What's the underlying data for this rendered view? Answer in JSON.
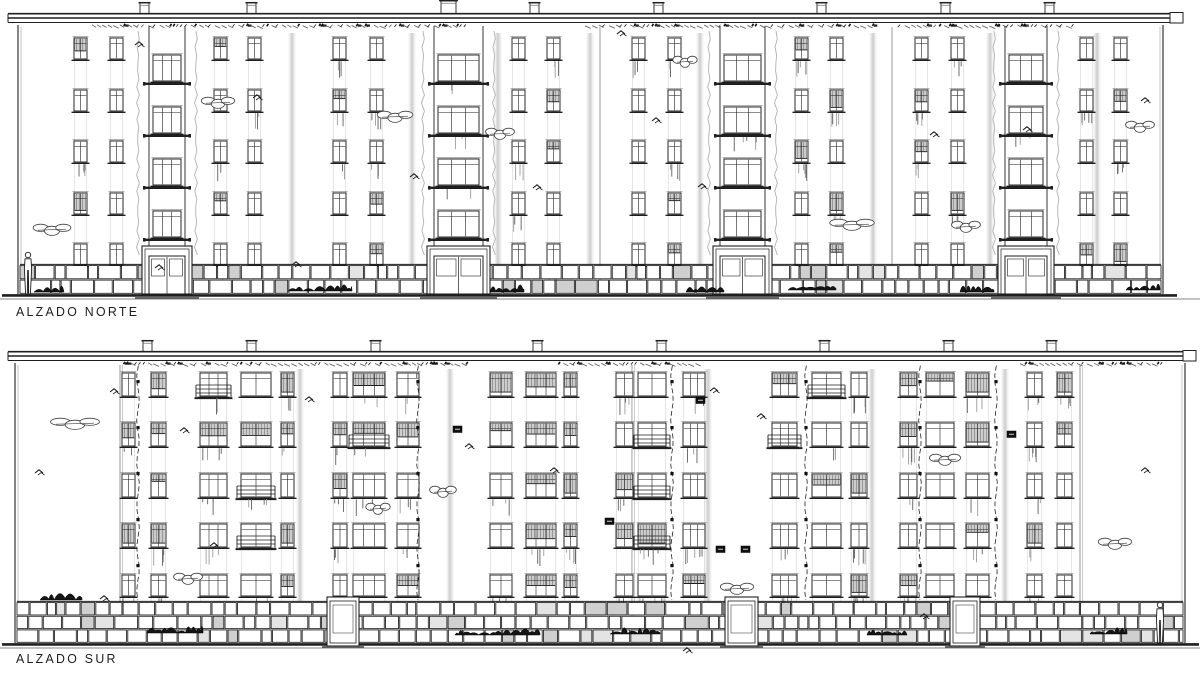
{
  "sheet": {
    "title_north": "ALZADO NORTE",
    "title_south": "ALZADO SUR"
  },
  "colors": {
    "paper": "#ffffff",
    "ink": "#1f1f1f",
    "soft": "#555555",
    "gray": "#8a8a8a",
    "faint": "#c9c9c9"
  },
  "canvas": {
    "w": 1200,
    "h": 675
  },
  "north": {
    "label": {
      "x": 16,
      "y": 304
    },
    "wall": {
      "x1": 18,
      "x2": 1163,
      "top": 25,
      "ground": 294
    },
    "roof": {
      "x1": 8,
      "x2": 1183,
      "y": 13
    },
    "joints": [
      600,
      892
    ],
    "chimneys": [
      {
        "x": 140,
        "w": 9
      },
      {
        "x": 247,
        "w": 9
      },
      {
        "x": 441,
        "w": 15,
        "cap": true
      },
      {
        "x": 530,
        "w": 9
      },
      {
        "x": 654,
        "w": 9
      },
      {
        "x": 817,
        "w": 9
      },
      {
        "x": 941,
        "w": 9
      },
      {
        "x": 1045,
        "w": 9
      }
    ],
    "hatch": [
      [
        92,
        470
      ],
      [
        585,
        875
      ],
      [
        900,
        1075
      ]
    ],
    "rows": [
      38,
      90,
      141,
      193,
      244
    ],
    "win": {
      "w": 13,
      "h": 21
    },
    "cols": [
      74,
      110,
      214,
      248,
      333,
      370,
      512,
      547,
      632,
      668,
      795,
      830,
      915,
      951,
      1080,
      1114
    ],
    "bays": [
      {
        "x": 150,
        "w": 34
      },
      {
        "x": 435,
        "w": 47
      },
      {
        "x": 721,
        "w": 43
      },
      {
        "x": 1006,
        "w": 40
      }
    ],
    "bay_rows": [
      55,
      107,
      159,
      211
    ],
    "base": {
      "top": 265,
      "rows": 2
    },
    "streaks": [
      292,
      412,
      498,
      590,
      700,
      873,
      990,
      1097
    ],
    "clouds": [
      [
        52,
        229,
        34
      ],
      [
        218,
        102,
        30
      ],
      [
        395,
        116,
        32
      ],
      [
        500,
        133,
        26
      ],
      [
        685,
        61,
        22
      ],
      [
        852,
        224,
        40
      ],
      [
        966,
        226,
        26
      ],
      [
        1140,
        126,
        26
      ]
    ],
    "birds": [
      [
        140,
        44
      ],
      [
        258,
        97
      ],
      [
        415,
        176
      ],
      [
        538,
        187
      ],
      [
        622,
        33
      ],
      [
        657,
        120
      ],
      [
        703,
        186
      ],
      [
        935,
        134
      ],
      [
        1028,
        129
      ],
      [
        1146,
        100
      ],
      [
        160,
        267
      ],
      [
        297,
        264
      ]
    ],
    "dark_bushes": [
      [
        34,
        64,
        292
      ],
      [
        288,
        352,
        291
      ],
      [
        490,
        524,
        292
      ],
      [
        686,
        724,
        292
      ],
      [
        788,
        836,
        290
      ],
      [
        960,
        994,
        292
      ],
      [
        1126,
        1160,
        290
      ]
    ],
    "persons": [
      [
        24,
        252
      ]
    ]
  },
  "south": {
    "label": {
      "x": 16,
      "y": 651
    },
    "wall": {
      "x1": 15,
      "x2": 1185,
      "top": 363,
      "ground": 643
    },
    "roof": {
      "x1": 8,
      "x2": 1196,
      "y": 351
    },
    "joints": [
      120,
      632,
      1080
    ],
    "chimneys": [
      {
        "x": 143,
        "w": 9
      },
      {
        "x": 247,
        "w": 9
      },
      {
        "x": 371,
        "w": 9
      },
      {
        "x": 533,
        "w": 9
      },
      {
        "x": 657,
        "w": 9
      },
      {
        "x": 820,
        "w": 9
      },
      {
        "x": 944,
        "w": 9
      },
      {
        "x": 1047,
        "w": 9
      }
    ],
    "hatch": [
      [
        125,
        470
      ],
      [
        560,
        700
      ],
      [
        1020,
        1165
      ]
    ],
    "rows": [
      373,
      423,
      474,
      524,
      575
    ],
    "win_h": 23,
    "cols": [
      {
        "x": 122,
        "w": 13,
        "p": 2
      },
      {
        "x": 151,
        "w": 15,
        "p": 2
      },
      {
        "x": 200,
        "w": 27,
        "p": 3
      },
      {
        "x": 241,
        "w": 30,
        "p": 2
      },
      {
        "x": 281,
        "w": 13,
        "p": 2
      },
      {
        "x": 333,
        "w": 14,
        "p": 2
      },
      {
        "x": 353,
        "w": 32,
        "p": 3
      },
      {
        "x": 397,
        "w": 22,
        "p": 2
      },
      {
        "x": 490,
        "w": 22,
        "p": 2
      },
      {
        "x": 526,
        "w": 30,
        "p": 3
      },
      {
        "x": 564,
        "w": 13,
        "p": 2
      },
      {
        "x": 616,
        "w": 17,
        "p": 2
      },
      {
        "x": 638,
        "w": 28,
        "p": 2
      },
      {
        "x": 683,
        "w": 22,
        "p": 3
      },
      {
        "x": 772,
        "w": 25,
        "p": 3
      },
      {
        "x": 812,
        "w": 29,
        "p": 2
      },
      {
        "x": 851,
        "w": 16,
        "p": 2
      },
      {
        "x": 900,
        "w": 17,
        "p": 2
      },
      {
        "x": 926,
        "w": 28,
        "p": 2
      },
      {
        "x": 966,
        "w": 23,
        "p": 2
      },
      {
        "x": 1027,
        "w": 15,
        "p": 2
      },
      {
        "x": 1057,
        "w": 15,
        "p": 2
      }
    ],
    "downspouts": [
      138,
      418,
      672,
      806,
      920,
      996
    ],
    "doors": [
      {
        "x": 330,
        "w": 26
      },
      {
        "x": 728,
        "w": 27
      },
      {
        "x": 953,
        "w": 24
      }
    ],
    "base": {
      "top": 602,
      "rows": 3
    },
    "streaks": [
      300,
      450,
      708,
      872,
      1005
    ],
    "clouds": [
      [
        75,
        423,
        44
      ],
      [
        188,
        578,
        26
      ],
      [
        443,
        491,
        24
      ],
      [
        737,
        588,
        30
      ],
      [
        945,
        459,
        28
      ],
      [
        1115,
        543,
        30
      ],
      [
        378,
        508,
        22
      ]
    ],
    "birds": [
      [
        40,
        472
      ],
      [
        115,
        391
      ],
      [
        185,
        430
      ],
      [
        310,
        399
      ],
      [
        470,
        446
      ],
      [
        555,
        470
      ],
      [
        715,
        390
      ],
      [
        762,
        416
      ],
      [
        925,
        616
      ],
      [
        1146,
        470
      ],
      [
        215,
        545
      ],
      [
        688,
        650
      ],
      [
        105,
        598
      ]
    ],
    "dark_bushes": [
      [
        40,
        82,
        600
      ],
      [
        147,
        203,
        633
      ],
      [
        455,
        540,
        635
      ],
      [
        610,
        660,
        634
      ],
      [
        867,
        907,
        635
      ],
      [
        1090,
        1127,
        634
      ]
    ],
    "vents": [
      [
        453,
        426
      ],
      [
        605,
        518
      ],
      [
        696,
        397
      ],
      [
        716,
        546
      ],
      [
        741,
        546
      ],
      [
        1007,
        431
      ]
    ],
    "persons": [
      [
        1156,
        602
      ]
    ]
  }
}
